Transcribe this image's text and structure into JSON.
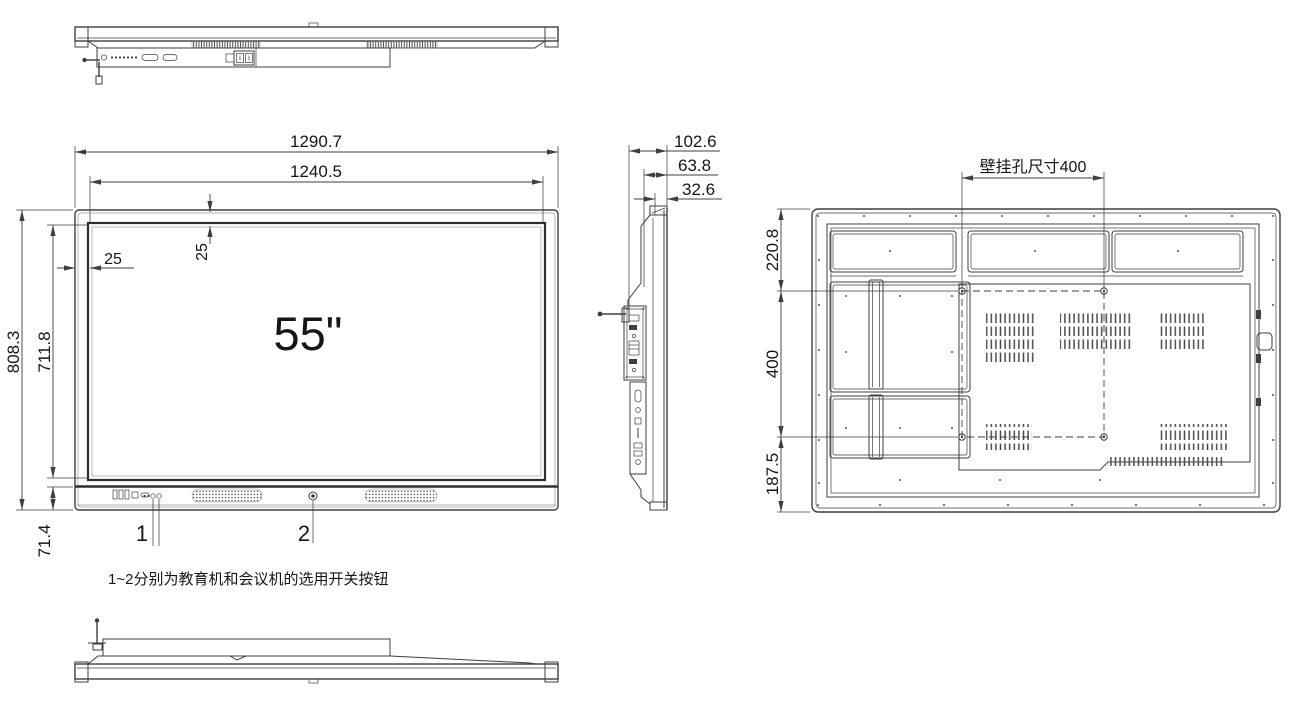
{
  "colors": {
    "background": "#ffffff",
    "line": "#3f3f3f",
    "text": "#161616"
  },
  "front_view": {
    "size_label": "55\"",
    "dims": {
      "outer_width": "1290.7",
      "screen_width": "1240.5",
      "bezel_top": "25",
      "bezel_left": "25",
      "outer_height": "808.3",
      "screen_height": "711.8",
      "bottom_section_height": "71.4"
    },
    "callouts": {
      "button1": "1",
      "button2": "2"
    }
  },
  "side_view": {
    "dims": {
      "total_depth": "102.6",
      "body_depth": "63.8",
      "panel_depth": "32.6"
    }
  },
  "rear_view": {
    "mount_label": "壁挂孔尺寸400",
    "dims": {
      "top_offset": "220.8",
      "mount_spacing": "400",
      "bottom_offset": "187.5"
    }
  },
  "footnote": "1~2分别为教育机和会议机的选用开关按钮"
}
